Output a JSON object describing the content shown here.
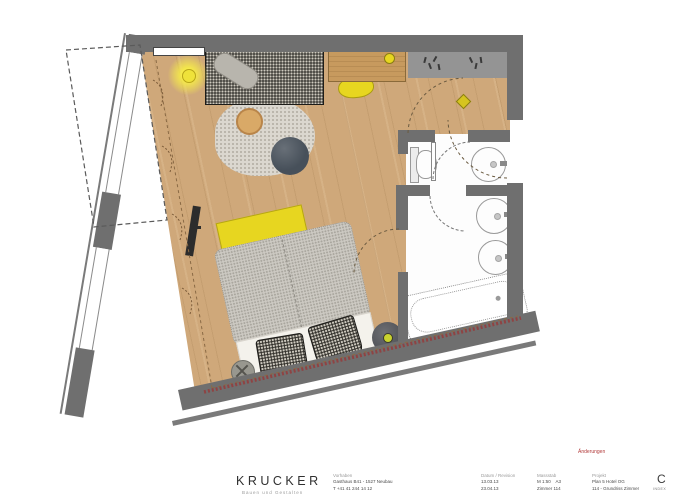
{
  "palette": {
    "wall": "#6f6f6f",
    "wall_light": "#949494",
    "wood": "#cfa87a",
    "wood_dark": "#c79a5e",
    "yellow": "#e7d620",
    "duvet": "#ccc9c2",
    "tweed": "#33312c",
    "rug": "#dbd7cf",
    "red_line": "#8f4343",
    "bath": "#fdfdfd",
    "pouf": "#47505a",
    "outline": "#999999"
  },
  "plan": {
    "type": "hotel-room floor plan, scale 1:50, plan rotated slightly",
    "furniture": [
      "daybed",
      "round-rug",
      "round-side-table",
      "pouf",
      "ceiling-lamp",
      "desk",
      "desk-lamp",
      "desk-chair",
      "wardrobe",
      "tv",
      "double-bed",
      "yellow-throw",
      "pillows",
      "bedside-table",
      "stool",
      "toilet",
      "washbasin",
      "double-vanity",
      "bathtub",
      "curtains",
      "terrace-awning"
    ]
  },
  "title_block": {
    "logo": "KRUCKER",
    "logo_tagline": "Bauen und Gestalten",
    "note_red": "Änderungen",
    "columns": [
      {
        "label": "Vorhaben",
        "lines": [
          "Gasthaus B41 - 1527 Neubau",
          "T +41 41 244 14 12"
        ]
      },
      {
        "label": "Datum / Revision",
        "lines": [
          "13.03.13",
          "23.04.13"
        ]
      },
      {
        "label": "Massstab",
        "lines": [
          "M 1:50    A3",
          "Zimmer 114"
        ]
      },
      {
        "label": "Projekt",
        "lines": [
          "Plan 5 Hotel OG",
          "114 - Grundriss Zimmer"
        ]
      }
    ],
    "revision_letter": "C",
    "revision_sub": "INDEX"
  }
}
